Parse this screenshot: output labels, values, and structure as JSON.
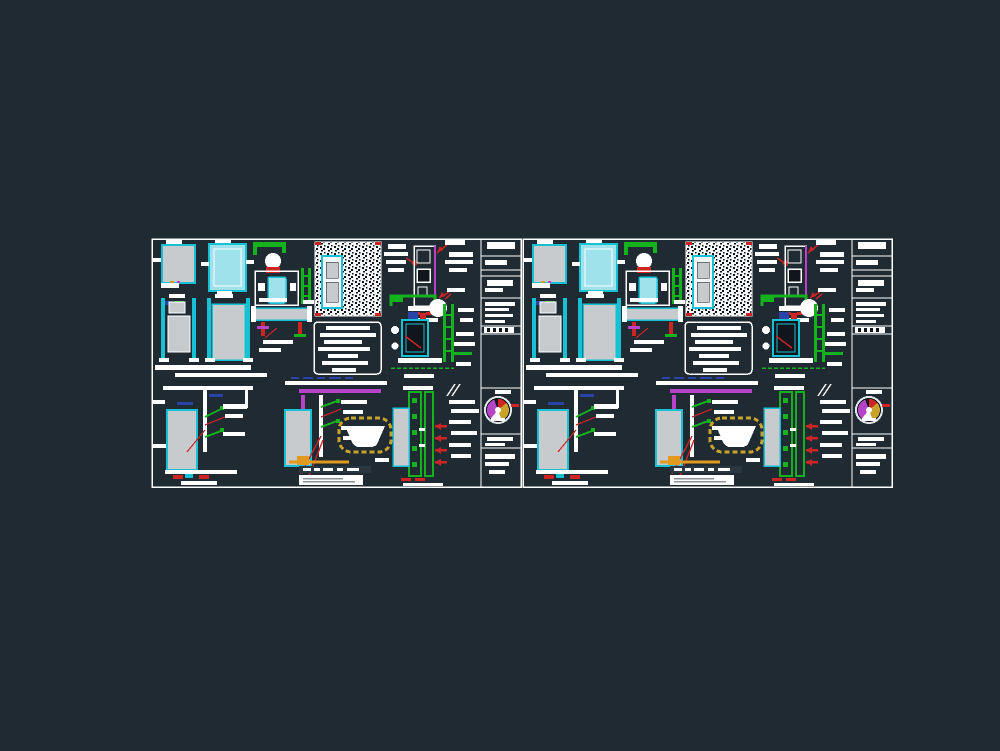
{
  "canvas": {
    "background": "#1f2a33",
    "content_note": "CAD drawing montage: two side-by-side sanitary installation detail sheets; all annotation text is smaller than legibility and appears as white bars"
  },
  "palette": {
    "white": "#ffffff",
    "paper": "#f4f6f7",
    "cyan": "#17c0d2",
    "cyan_light": "#9fe2ec",
    "gray_fill": "#c7cbce",
    "green": "#14b31e",
    "red": "#cf2424",
    "magenta": "#b743c9",
    "blue": "#2a43a8",
    "gold": "#c9a22b",
    "orange": "#e19a1d",
    "dark": "#10161c",
    "band": "#2a3640",
    "tick": "#8a9096",
    "stamp_ring": "#dde4e8"
  },
  "details": {
    "d1": {
      "name": "frame-elevation-small"
    },
    "d2": {
      "name": "frame-elevation-cyan"
    },
    "d3": {
      "name": "toilet-plan-detail"
    },
    "d4": {
      "name": "hatched-wall-section"
    },
    "d5": {
      "name": "cistern-section-detail"
    },
    "d6": {
      "name": "annotation-stack-top-right"
    },
    "d7": {
      "name": "frame-section-left"
    },
    "d8": {
      "name": "frame-section-right"
    },
    "d9": {
      "name": "beam-plan-detail"
    },
    "d10": {
      "name": "notes-panel"
    },
    "d11": {
      "name": "water-heater-detail"
    },
    "d12": {
      "name": "annotation-stack-mid-right"
    },
    "d13": {
      "name": "wall-section-a"
    },
    "d14": {
      "name": "wall-section-bathtub"
    },
    "d15": {
      "name": "wall-section-c"
    },
    "strip": {
      "name": "title-strip"
    },
    "stamp": {
      "name": "stamp-logo"
    }
  },
  "sheets": [
    {
      "id": "sheet-1",
      "name": "detail-sheet-left"
    },
    {
      "id": "sheet-2",
      "name": "detail-sheet-right"
    }
  ]
}
